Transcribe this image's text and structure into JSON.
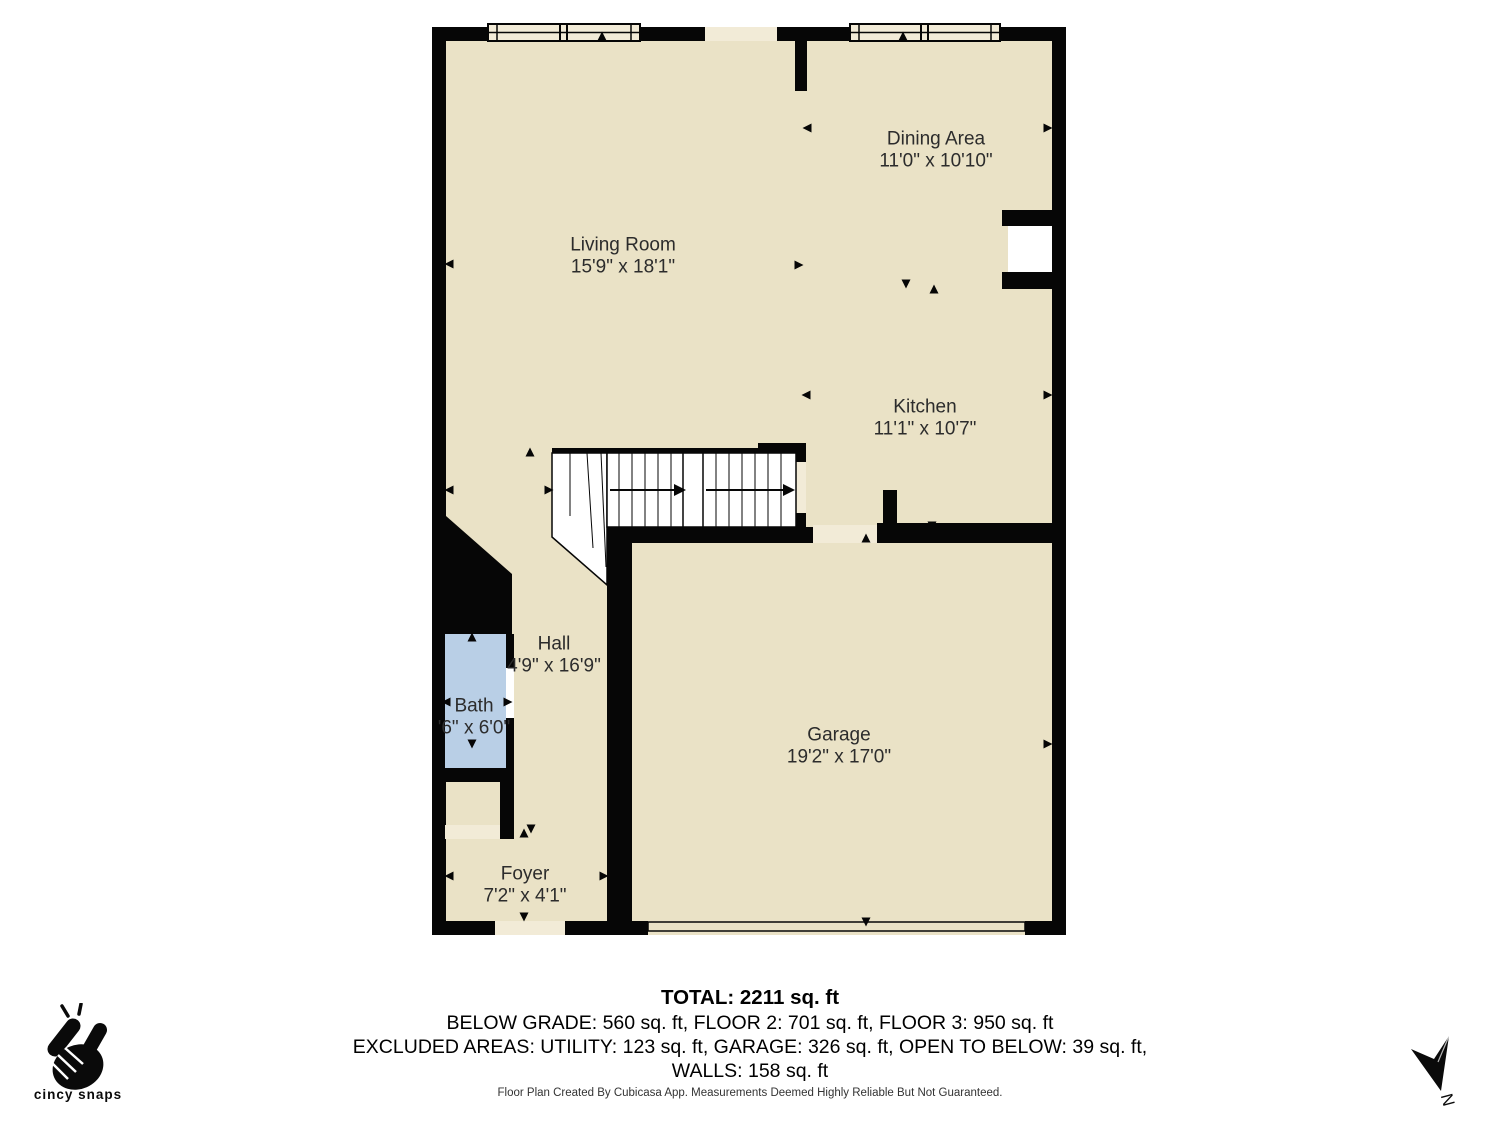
{
  "rooms": [
    {
      "id": "living-room",
      "name": "Living Room",
      "dims": "15'9\" x 18'1\"",
      "x": 623,
      "y": 257
    },
    {
      "id": "dining-area",
      "name": "Dining Area",
      "dims": "11'0\" x 10'10\"",
      "x": 936,
      "y": 151
    },
    {
      "id": "kitchen",
      "name": "Kitchen",
      "dims": "11'1\" x 10'7\"",
      "x": 925,
      "y": 419
    },
    {
      "id": "hall",
      "name": "Hall",
      "dims": "4'9\" x 16'9\"",
      "x": 554,
      "y": 656
    },
    {
      "id": "bath",
      "name": "Bath",
      "dims": "'6\" x 6'0\"",
      "x": 474,
      "y": 718
    },
    {
      "id": "garage",
      "name": "Garage",
      "dims": "19'2\" x 17'0\"",
      "x": 839,
      "y": 747
    },
    {
      "id": "foyer",
      "name": "Foyer",
      "dims": "7'2\" x 4'1\"",
      "x": 525,
      "y": 886
    }
  ],
  "summary": {
    "total": "TOTAL: 2211 sq. ft",
    "areas_line": "BELOW GRADE: 560 sq. ft, FLOOR 2: 701 sq. ft, FLOOR 3: 950 sq. ft",
    "excluded_line": "EXCLUDED AREAS: UTILITY: 123 sq. ft, GARAGE: 326 sq. ft, OPEN TO BELOW: 39 sq. ft,",
    "walls_line": "WALLS: 158 sq. ft",
    "disclaimer": "Floor Plan Created By Cubicasa App. Measurements Deemed Highly Reliable But Not Guaranteed."
  },
  "branding": {
    "logo_text": "cincy snaps"
  },
  "compass": {
    "label": "N"
  },
  "colors": {
    "floor": "#EAE2C6",
    "opening": "#F2EBD7",
    "bath": "#B9CFE6",
    "wall": "#060606",
    "label_text": "#2c2c2c"
  }
}
